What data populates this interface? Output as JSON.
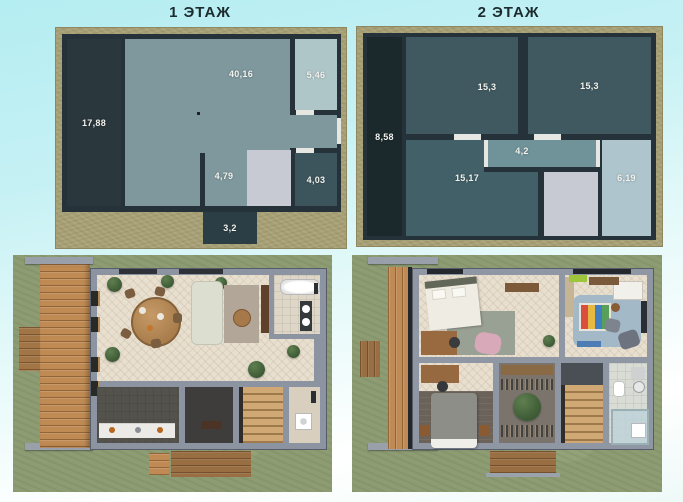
{
  "floor1": {
    "title": "1 ЭТАЖ",
    "rooms": {
      "terrace": "17,88",
      "living": "40,16",
      "bathroom": "5,46",
      "hall": "4,79",
      "utility": "4,03",
      "porch": "3,2"
    }
  },
  "floor2": {
    "title": "2 ЭТАЖ",
    "rooms": {
      "balcony": "8,58",
      "bedroom_left": "15,3",
      "bedroom_right": "15,3",
      "corridor": "4,2",
      "bedroom_bottom": "15,17",
      "bathroom": "6,19"
    }
  },
  "colors": {
    "background_top": "#b4edf2",
    "background_bottom": "#ffffff",
    "frame_khaki": "#a69f74",
    "wall_dark": "#26323a",
    "room_teal": "#7e989e",
    "room_dark_teal": "#405960",
    "room_light_blue": "#afc6c9",
    "stairs_gray": "#c8cad3",
    "grass_green": "#8d9c72",
    "deck_wood": "#bf8a53",
    "title_text": "#1c2b2e",
    "label_text": "#f2f2ee"
  }
}
